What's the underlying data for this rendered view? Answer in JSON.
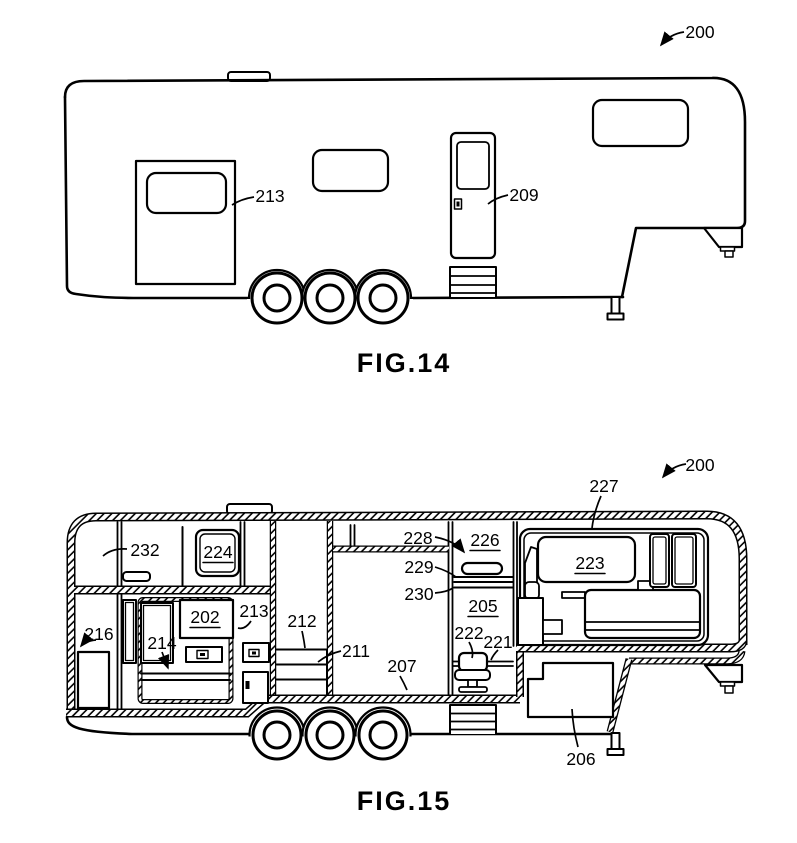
{
  "page": {
    "paper_color": "#ffffff",
    "ink_color": "#000000"
  },
  "fig14": {
    "caption": "FIG.14",
    "labels": {
      "r200": "200",
      "r213": "213",
      "r209": "209"
    }
  },
  "fig15": {
    "caption": "FIG.15",
    "labels": {
      "r200": "200",
      "r227": "227",
      "r232": "232",
      "r224": "224",
      "r228": "228",
      "r226": "226",
      "r229": "229",
      "r230": "230",
      "r223": "223",
      "r205": "205",
      "r202": "202",
      "r213": "213",
      "r212": "212",
      "r216": "216",
      "r214": "214",
      "r211": "211",
      "r222": "222",
      "r221": "221",
      "r207": "207",
      "r206": "206"
    }
  }
}
